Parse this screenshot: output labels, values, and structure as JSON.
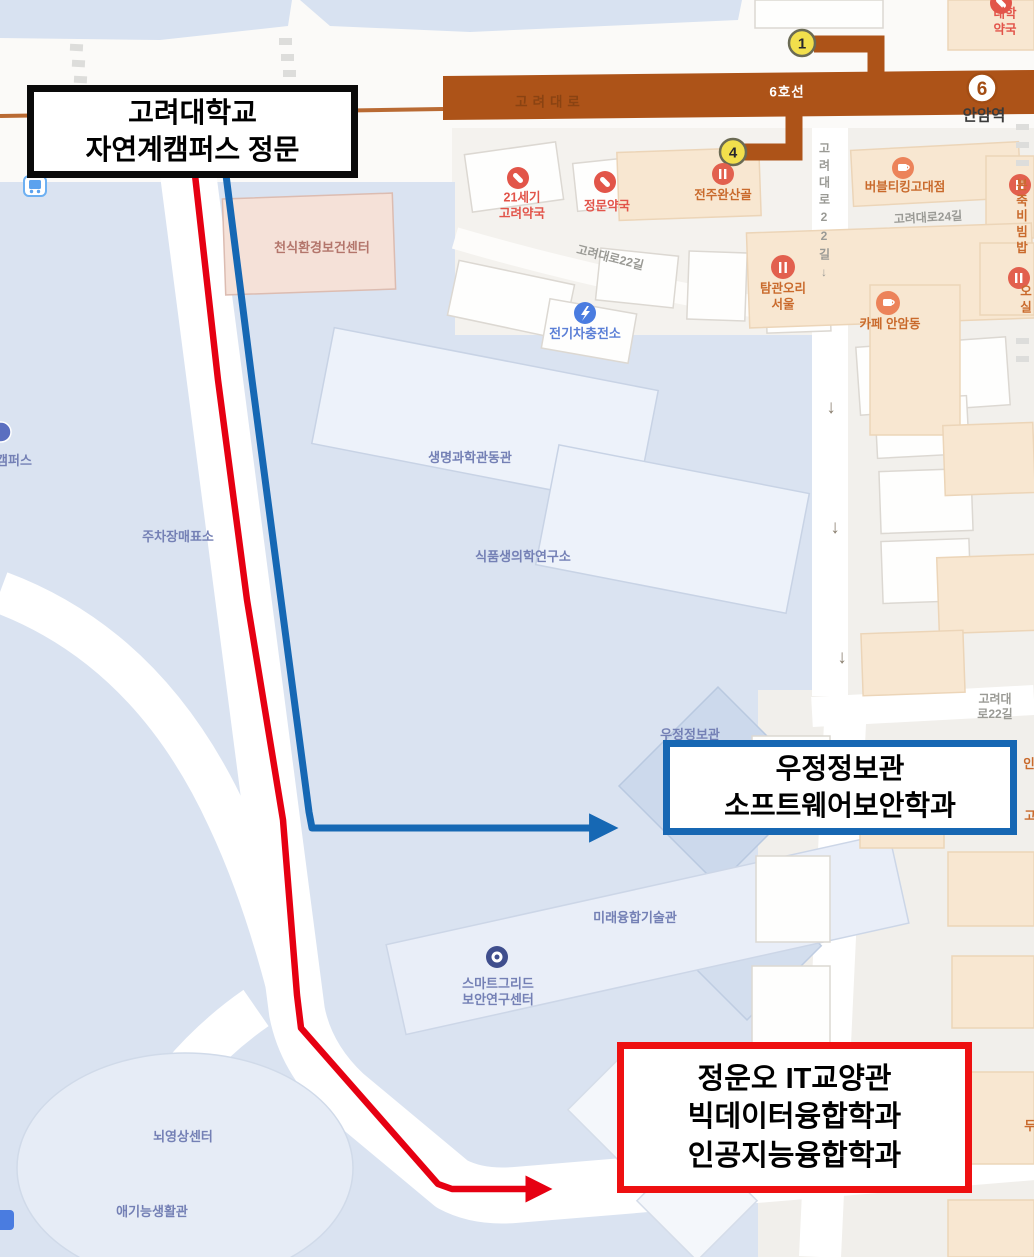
{
  "annotations": {
    "gate_box": {
      "line1": "고려대학교",
      "line2": "자연계캠퍼스 정문"
    },
    "blue_box": {
      "line1": "우정정보관",
      "line2": "소프트웨어보안학과"
    },
    "red_box": {
      "line1": "정운오 IT교양관",
      "line2": "빅데이터융합학과",
      "line3": "인공지능융합학과"
    },
    "colors": {
      "red_route": "#e60012",
      "blue_route": "#1668b4",
      "gate_border": "#0a0a0a"
    }
  },
  "subway": {
    "road_on_band": "고려대로",
    "line_name": "6호선",
    "station": "안암역",
    "line_number": "6",
    "exit_north": "1",
    "exit_south": "4",
    "band_color": "#ad5318"
  },
  "campus": {
    "partial_campus": "캠퍼스",
    "parking": "주차장매표소",
    "life_science": "생명과학관동관",
    "food_biomed": "식품생의학연구소",
    "future_tech": "미래융합기술관",
    "smart_grid": "스마트그리드\n보안연구센터",
    "brain": "뇌영상센터",
    "aegineung": "애기능생활관",
    "woojung_bg": "우정정보관",
    "asthma": "천식환경보건센터",
    "ev": "전기차충전소"
  },
  "poi": {
    "univ_pharm": "대학약국",
    "pharm21": "21세기\n고려약국",
    "gate_pharm": "정문약국",
    "jeonju": "전주완산골",
    "tamgwan": "탐관오리\n서울",
    "bubble": "버블티킹고대점",
    "bonjuk": "본죽\n비빔밥",
    "cafe_anam": "카페 안암동",
    "osil": "오실",
    "partial_in": "인",
    "partial_go": "고",
    "partial_du": "두"
  },
  "roads": {
    "r22_diag": "고려대로22길",
    "r22_vert": "고려대로22길↓",
    "r24": "고려대로24길",
    "r22_bottom": "고려대로22길",
    "down_arrow": "↓"
  }
}
